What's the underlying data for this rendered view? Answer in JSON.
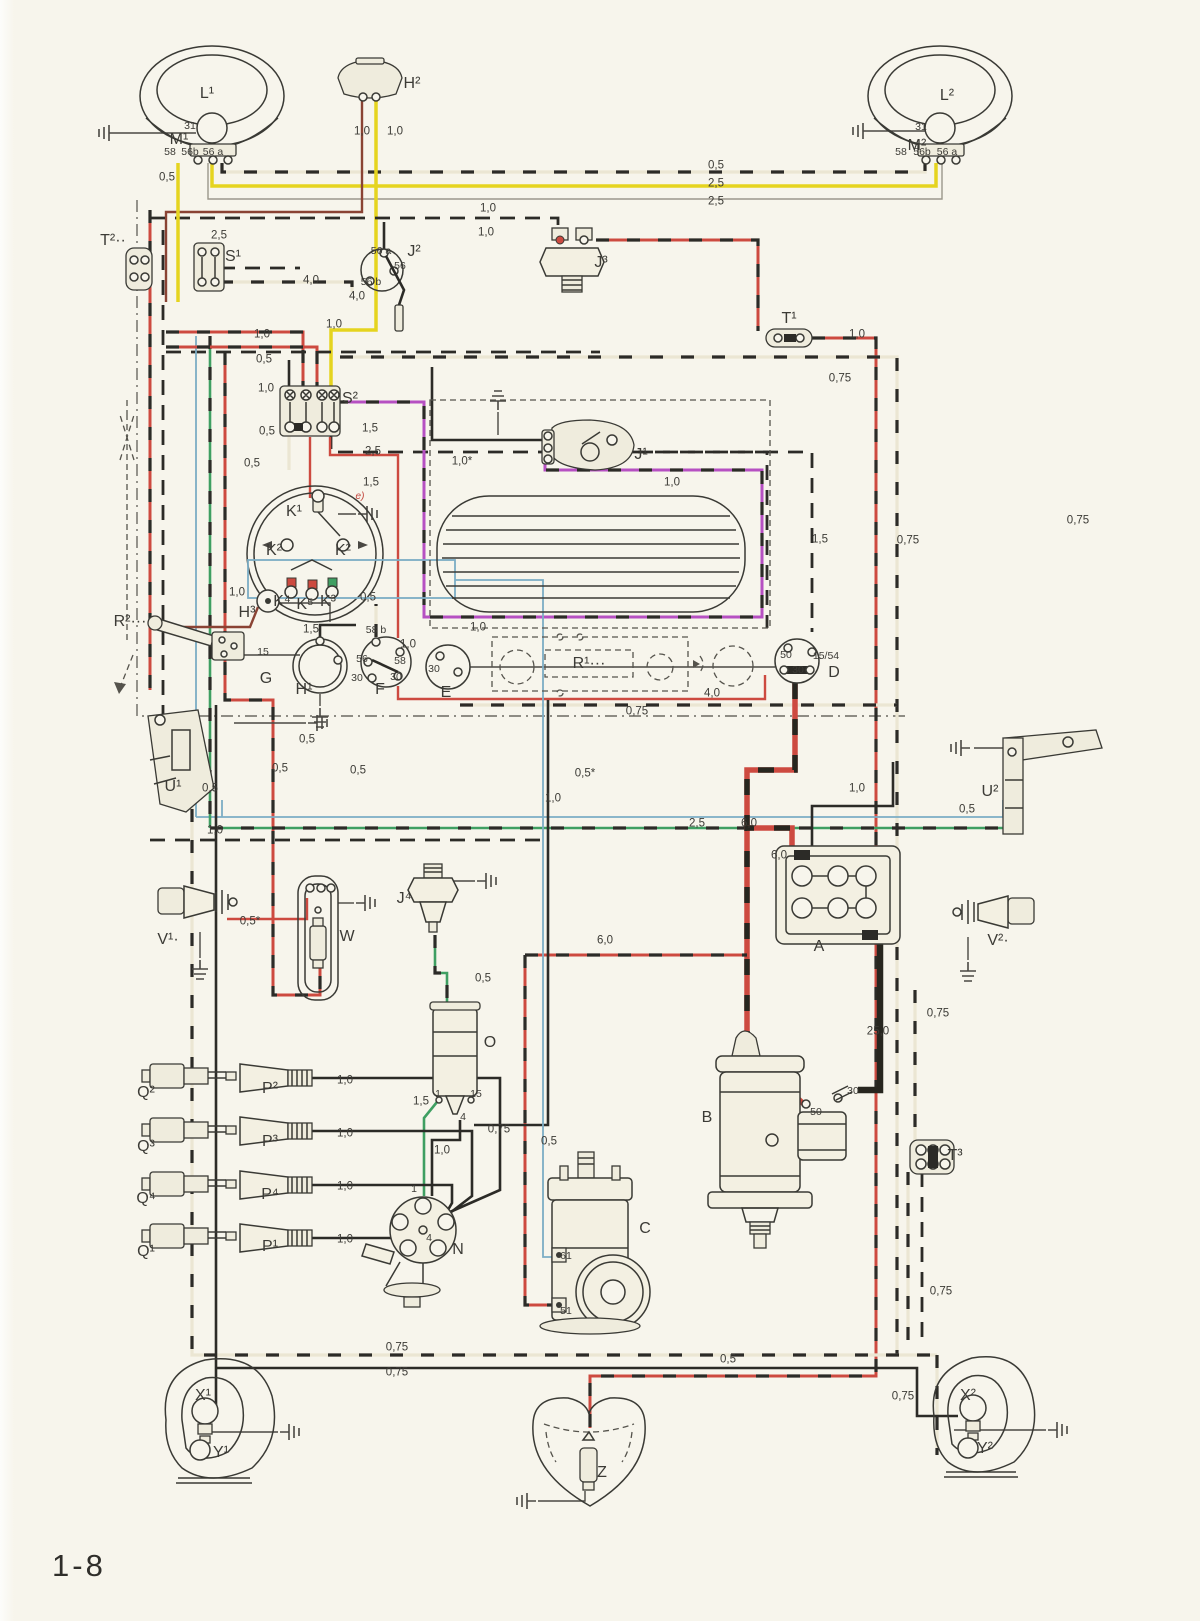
{
  "page": {
    "number": "1-8"
  },
  "colors": {
    "paper": "#f7f5ec",
    "line": "#3a3a35",
    "wire_black": "#2c2b27",
    "wire_red": "#cd4a40",
    "wire_yellow": "#e5d41f",
    "wire_green": "#3f9f62",
    "wire_blue": "#7cadc5",
    "wire_magenta": "#b650c2",
    "wire_brown": "#8a4334",
    "wire_cream": "#ebe6d3"
  },
  "component_labels": [
    {
      "t": "L¹",
      "x": 207,
      "y": 94,
      "id": "L1"
    },
    {
      "t": "H²",
      "x": 412,
      "y": 84,
      "id": "H2"
    },
    {
      "t": "L²",
      "x": 947,
      "y": 96,
      "id": "L2"
    },
    {
      "t": "M¹",
      "x": 179,
      "y": 140,
      "id": "M1"
    },
    {
      "t": "M²",
      "x": 917,
      "y": 146,
      "id": "M2"
    },
    {
      "t": "T²··",
      "x": 113,
      "y": 241,
      "id": "T2"
    },
    {
      "t": "S¹",
      "x": 233,
      "y": 257,
      "id": "S1"
    },
    {
      "t": "J²",
      "x": 414,
      "y": 252,
      "id": "J2"
    },
    {
      "t": "J³",
      "x": 601,
      "y": 263,
      "id": "J3"
    },
    {
      "t": "T¹",
      "x": 789,
      "y": 319,
      "id": "T1"
    },
    {
      "t": "S²",
      "x": 350,
      "y": 399,
      "id": "S2"
    },
    {
      "t": "K¹",
      "x": 294,
      "y": 512,
      "id": "K1"
    },
    {
      "t": "K²",
      "x": 274,
      "y": 551,
      "id": "K2-left"
    },
    {
      "t": "K²",
      "x": 343,
      "y": 551,
      "id": "K2-right"
    },
    {
      "t": "K⁴",
      "x": 282,
      "y": 602,
      "id": "K4"
    },
    {
      "t": "K⁵",
      "x": 305,
      "y": 605,
      "id": "K5"
    },
    {
      "t": "K³",
      "x": 328,
      "y": 602,
      "id": "K3"
    },
    {
      "t": "H³",
      "x": 247,
      "y": 613,
      "id": "H3"
    },
    {
      "t": "G",
      "x": 266,
      "y": 679,
      "id": "G"
    },
    {
      "t": "H¹",
      "x": 304,
      "y": 690,
      "id": "H1"
    },
    {
      "t": "J¹",
      "x": 641,
      "y": 455,
      "id": "J1"
    },
    {
      "t": "R¹···",
      "x": 589,
      "y": 664,
      "id": "R1"
    },
    {
      "t": "R²···",
      "x": 130,
      "y": 622,
      "id": "R2"
    },
    {
      "t": "F",
      "x": 380,
      "y": 690,
      "id": "F"
    },
    {
      "t": "E",
      "x": 446,
      "y": 693,
      "id": "E"
    },
    {
      "t": "D",
      "x": 834,
      "y": 673,
      "id": "D"
    },
    {
      "t": "U¹",
      "x": 173,
      "y": 787,
      "id": "U1"
    },
    {
      "t": "U²",
      "x": 990,
      "y": 792,
      "id": "U2"
    },
    {
      "t": "V¹·",
      "x": 168,
      "y": 940,
      "id": "V1"
    },
    {
      "t": "V²·",
      "x": 998,
      "y": 941,
      "id": "V2"
    },
    {
      "t": "W",
      "x": 347,
      "y": 937,
      "id": "W"
    },
    {
      "t": "J⁴",
      "x": 404,
      "y": 899,
      "id": "J4"
    },
    {
      "t": "A",
      "x": 819,
      "y": 947,
      "id": "A"
    },
    {
      "t": "B",
      "x": 707,
      "y": 1118,
      "id": "B"
    },
    {
      "t": "C",
      "x": 645,
      "y": 1229,
      "id": "C"
    },
    {
      "t": "N",
      "x": 458,
      "y": 1250,
      "id": "N"
    },
    {
      "t": "O",
      "x": 490,
      "y": 1043,
      "id": "O"
    },
    {
      "t": "Q²",
      "x": 146,
      "y": 1093,
      "id": "Q2"
    },
    {
      "t": "Q³",
      "x": 146,
      "y": 1147,
      "id": "Q3"
    },
    {
      "t": "Q⁴",
      "x": 146,
      "y": 1199,
      "id": "Q4"
    },
    {
      "t": "Q¹",
      "x": 146,
      "y": 1252,
      "id": "Q1"
    },
    {
      "t": "P²",
      "x": 270,
      "y": 1089,
      "id": "P2"
    },
    {
      "t": "P³",
      "x": 270,
      "y": 1142,
      "id": "P3"
    },
    {
      "t": "P⁴",
      "x": 270,
      "y": 1195,
      "id": "P4"
    },
    {
      "t": "P¹",
      "x": 270,
      "y": 1247,
      "id": "P1"
    },
    {
      "t": "T³",
      "x": 955,
      "y": 1156,
      "id": "T3"
    },
    {
      "t": "X¹",
      "x": 203,
      "y": 1396,
      "id": "X1"
    },
    {
      "t": "Y¹",
      "x": 221,
      "y": 1453,
      "id": "Y1"
    },
    {
      "t": "X²",
      "x": 968,
      "y": 1396,
      "id": "X2"
    },
    {
      "t": "Y²",
      "x": 985,
      "y": 1449,
      "id": "Y2"
    },
    {
      "t": "Z",
      "x": 602,
      "y": 1473,
      "id": "Z"
    }
  ],
  "terminal_labels": [
    {
      "t": "31",
      "x": 190,
      "y": 126
    },
    {
      "t": "58",
      "x": 170,
      "y": 152
    },
    {
      "t": "56b",
      "x": 190,
      "y": 152
    },
    {
      "t": "56 a",
      "x": 213,
      "y": 152
    },
    {
      "t": "31",
      "x": 921,
      "y": 127
    },
    {
      "t": "58",
      "x": 901,
      "y": 152
    },
    {
      "t": "56b",
      "x": 922,
      "y": 152
    },
    {
      "t": "56 a",
      "x": 947,
      "y": 152
    },
    {
      "t": "56 a",
      "x": 381,
      "y": 251
    },
    {
      "t": "56",
      "x": 400,
      "y": 266
    },
    {
      "t": "56 b",
      "x": 371,
      "y": 282
    },
    {
      "t": "58 b",
      "x": 376,
      "y": 630
    },
    {
      "t": "56",
      "x": 362,
      "y": 659
    },
    {
      "t": "58",
      "x": 400,
      "y": 661
    },
    {
      "t": "30",
      "x": 357,
      "y": 678
    },
    {
      "t": "30",
      "x": 396,
      "y": 677
    },
    {
      "t": "30",
      "x": 434,
      "y": 669
    },
    {
      "t": "50",
      "x": 786,
      "y": 655
    },
    {
      "t": "30",
      "x": 798,
      "y": 670
    },
    {
      "t": "15/54",
      "x": 826,
      "y": 656
    },
    {
      "t": "15",
      "x": 263,
      "y": 652
    },
    {
      "t": "50",
      "x": 816,
      "y": 1112
    },
    {
      "t": "30",
      "x": 853,
      "y": 1091
    },
    {
      "t": "61",
      "x": 566,
      "y": 1256
    },
    {
      "t": "51",
      "x": 566,
      "y": 1311
    },
    {
      "t": "1",
      "x": 438,
      "y": 1094
    },
    {
      "t": "15",
      "x": 476,
      "y": 1094
    },
    {
      "t": "4",
      "x": 463,
      "y": 1117
    },
    {
      "t": "1",
      "x": 414,
      "y": 1189
    },
    {
      "t": "4",
      "x": 429,
      "y": 1238
    }
  ],
  "wire_labels": [
    {
      "t": "0,5",
      "x": 167,
      "y": 178
    },
    {
      "t": "2,5",
      "x": 219,
      "y": 236
    },
    {
      "t": "4,0",
      "x": 311,
      "y": 281
    },
    {
      "t": "4,0",
      "x": 357,
      "y": 297
    },
    {
      "t": "1,0",
      "x": 362,
      "y": 132
    },
    {
      "t": "1,0",
      "x": 395,
      "y": 132
    },
    {
      "t": "0,5",
      "x": 716,
      "y": 166
    },
    {
      "t": "2,5",
      "x": 716,
      "y": 184
    },
    {
      "t": "2,5",
      "x": 716,
      "y": 202
    },
    {
      "t": "1,0",
      "x": 488,
      "y": 209
    },
    {
      "t": "1,0",
      "x": 486,
      "y": 233
    },
    {
      "t": "1,0",
      "x": 857,
      "y": 335
    },
    {
      "t": "0,75",
      "x": 840,
      "y": 379
    },
    {
      "t": "1,0",
      "x": 262,
      "y": 335
    },
    {
      "t": "1,0",
      "x": 334,
      "y": 325
    },
    {
      "t": "0,5",
      "x": 264,
      "y": 360
    },
    {
      "t": "1,0",
      "x": 266,
      "y": 389
    },
    {
      "t": "0,5",
      "x": 267,
      "y": 432
    },
    {
      "t": "1,5",
      "x": 370,
      "y": 429
    },
    {
      "t": "2,5",
      "x": 373,
      "y": 452
    },
    {
      "t": "0,5",
      "x": 252,
      "y": 464
    },
    {
      "t": "1,5",
      "x": 371,
      "y": 483
    },
    {
      "t": "e)",
      "x": 360,
      "y": 497,
      "red": true
    },
    {
      "t": "1,0",
      "x": 237,
      "y": 593
    },
    {
      "t": "0,5",
      "x": 368,
      "y": 598
    },
    {
      "t": "1,5",
      "x": 311,
      "y": 630
    },
    {
      "t": "1,0",
      "x": 408,
      "y": 645
    },
    {
      "t": "1,0*",
      "x": 462,
      "y": 462
    },
    {
      "t": "1,0",
      "x": 672,
      "y": 483
    },
    {
      "t": "1,0",
      "x": 478,
      "y": 628
    },
    {
      "t": "1,5",
      "x": 820,
      "y": 540
    },
    {
      "t": "0,75",
      "x": 908,
      "y": 541
    },
    {
      "t": "0,75",
      "x": 1078,
      "y": 521
    },
    {
      "t": "4,0",
      "x": 712,
      "y": 694
    },
    {
      "t": "0,75",
      "x": 637,
      "y": 712
    },
    {
      "t": "0,5",
      "x": 307,
      "y": 740
    },
    {
      "t": "0,5",
      "x": 280,
      "y": 769
    },
    {
      "t": "0,5",
      "x": 358,
      "y": 771
    },
    {
      "t": "0,5",
      "x": 210,
      "y": 789
    },
    {
      "t": "1,0",
      "x": 215,
      "y": 831
    },
    {
      "t": "0,5*",
      "x": 585,
      "y": 774
    },
    {
      "t": "1,0",
      "x": 553,
      "y": 799
    },
    {
      "t": "1,0",
      "x": 857,
      "y": 789
    },
    {
      "t": "0,5",
      "x": 967,
      "y": 810
    },
    {
      "t": "2,5",
      "x": 697,
      "y": 824
    },
    {
      "t": "6,0",
      "x": 749,
      "y": 824
    },
    {
      "t": "6,0",
      "x": 779,
      "y": 856
    },
    {
      "t": "6,0",
      "x": 605,
      "y": 941
    },
    {
      "t": "0,5*",
      "x": 250,
      "y": 922
    },
    {
      "t": "0,5",
      "x": 483,
      "y": 979
    },
    {
      "t": "1,5",
      "x": 421,
      "y": 1102
    },
    {
      "t": "0,75",
      "x": 499,
      "y": 1130
    },
    {
      "t": "0,5",
      "x": 549,
      "y": 1142
    },
    {
      "t": "1,0",
      "x": 442,
      "y": 1151
    },
    {
      "t": "1,0",
      "x": 345,
      "y": 1081
    },
    {
      "t": "1,0",
      "x": 345,
      "y": 1134
    },
    {
      "t": "1,0",
      "x": 345,
      "y": 1187
    },
    {
      "t": "1,0",
      "x": 345,
      "y": 1240
    },
    {
      "t": "25,0",
      "x": 878,
      "y": 1032
    },
    {
      "t": "0,75",
      "x": 938,
      "y": 1014
    },
    {
      "t": "0,75",
      "x": 941,
      "y": 1292
    },
    {
      "t": "0,75",
      "x": 903,
      "y": 1397
    },
    {
      "t": "0,75",
      "x": 397,
      "y": 1348
    },
    {
      "t": "0,75",
      "x": 397,
      "y": 1373
    },
    {
      "t": "0,5",
      "x": 728,
      "y": 1360
    }
  ]
}
